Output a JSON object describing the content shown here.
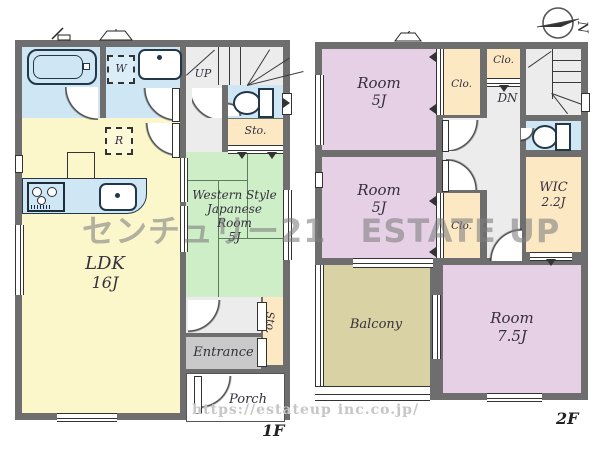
{
  "compass": {
    "label": "N"
  },
  "watermark": {
    "brand": "センチュリー21",
    "name": "ESTATE UP",
    "url": "https://estateup inc.co.jp/"
  },
  "floor1": {
    "label": "1F",
    "ldk": {
      "name": "LDK",
      "size": "16J"
    },
    "japanese_room": {
      "line1": "Western Style",
      "line2": "Japanese",
      "line3": "Room",
      "line4": "5J"
    },
    "washing_machine": "W",
    "refrigerator": "R",
    "stairs": "UP",
    "storage_top": "Sto.",
    "storage_entrance": "Sto.",
    "entrance": "Entrance",
    "porch": "Porch"
  },
  "floor2": {
    "label": "2F",
    "room_a": {
      "name": "Room",
      "size": "5J"
    },
    "room_b": {
      "name": "Room",
      "size": "5J"
    },
    "room_c": {
      "name": "Room",
      "size": "7.5J"
    },
    "closet_a": "Clo.",
    "closet_b": "Clo.",
    "closet_c": "Clo.",
    "stairs": "DN",
    "wic": {
      "name": "WIC",
      "size": "2.2J"
    },
    "balcony": "Balcony"
  },
  "colors": {
    "wall": "#6e6e6e",
    "water_rooms": "#cfe7f4",
    "ldk": "#fbf7cb",
    "japanese_room": "#cdeec6",
    "bedroom": "#e6d0e6",
    "storage": "#fce8c3",
    "balcony": "#d9d2a4",
    "hallway": "#ececec",
    "entrance": "#c9c9c9",
    "watermark": "#7e7e7e"
  }
}
